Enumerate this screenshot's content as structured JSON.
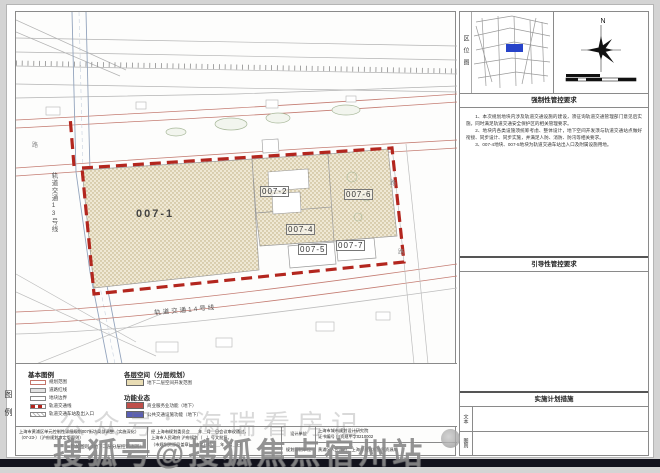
{
  "map": {
    "parcels": [
      {
        "id": "007-1"
      },
      {
        "id": "007-2"
      },
      {
        "id": "007-4"
      },
      {
        "id": "007-5"
      },
      {
        "id": "007-7"
      },
      {
        "id": "007-6"
      }
    ],
    "rail_line_13": "轨道交通13号线",
    "rail_line_14": "轨道交通14号线",
    "road_char": "路",
    "boundary_color": "#b3261e",
    "parcel_fill": "#ece2c8"
  },
  "sidebar": {
    "location_map": {
      "label": "区位图",
      "highlight_color": "#2743c9"
    },
    "compass": {
      "north_label": "N"
    },
    "sections": {
      "mandatory": {
        "title": "强制性管控要求",
        "paragraphs": [
          "1、本次规划地块内涉及轨道交通设施的建设，须征询轨道交通管理部门意见后实施，同时满足轨道交通安全保护区的相关管理要求。",
          "2、地块内各类设施须统筹考虑、整体设计，地下空间开发须与轨道交通站点做好衔接、同步设计、同步实施，并满足人防、消防、防汛等相关要求。",
          "3、007-4地块、007-5地块为轨道交通车站出入口及附属设施用地。"
        ]
      },
      "guiding": {
        "title": "引导性管控要求"
      },
      "implementation": {
        "title": "实施计划措施",
        "rows": [
          {
            "label": "文本"
          },
          {
            "label": "图则"
          }
        ]
      }
    }
  },
  "legend": {
    "side_label": "图例",
    "basic": {
      "title": "基本图例",
      "items": [
        {
          "label": "规划范围"
        },
        {
          "label": "道路红线"
        },
        {
          "label": "地块边界"
        },
        {
          "label": "轨道交通线"
        },
        {
          "label": "轨道交通车站及出入口"
        }
      ]
    },
    "layers": {
      "title": "各层空间（分层规划）",
      "items": [
        {
          "label": "地下二层空间开发范围",
          "color": "#e8dcb4"
        }
      ]
    },
    "functions": {
      "title": "功能业态",
      "items": [
        {
          "label": "商业服务业功能（地下）",
          "color": "#bf4f4a"
        },
        {
          "label": "公共交通设施功能（地下）",
          "color": "#5a5fb5"
        }
      ]
    }
  },
  "title_block": {
    "project_line1": "上海市黄浦区单元控制性详细规划007街坊局部调整（实施深化）",
    "project_line2": "（07-23-）（沪府规划审定版图则）",
    "project_line3": "附加图则（地下二层分层控制图则）",
    "approval_line1": "经 上海市规划委员会＿＿年＿月＿日会议审议通过，",
    "approval_line2": "上海市人民政府 沪府规划（　）号文批复。",
    "approval_line3": "（市规划资源局盖章）　审定日期：＿年＿月＿日",
    "design_label": "设计单位",
    "design_value_line1": "上海市城市规划设计研究院",
    "design_value_line2": "证书编号 自资规甲字0210002",
    "compile_label": "规划编制单位",
    "compile_value": "黄浦区人民政府、上海市规划和自然资源局"
  },
  "watermarks": {
    "line1": "公众号：海瑞看房记",
    "line2": "搜狐号@搜狐焦点宿州站"
  }
}
